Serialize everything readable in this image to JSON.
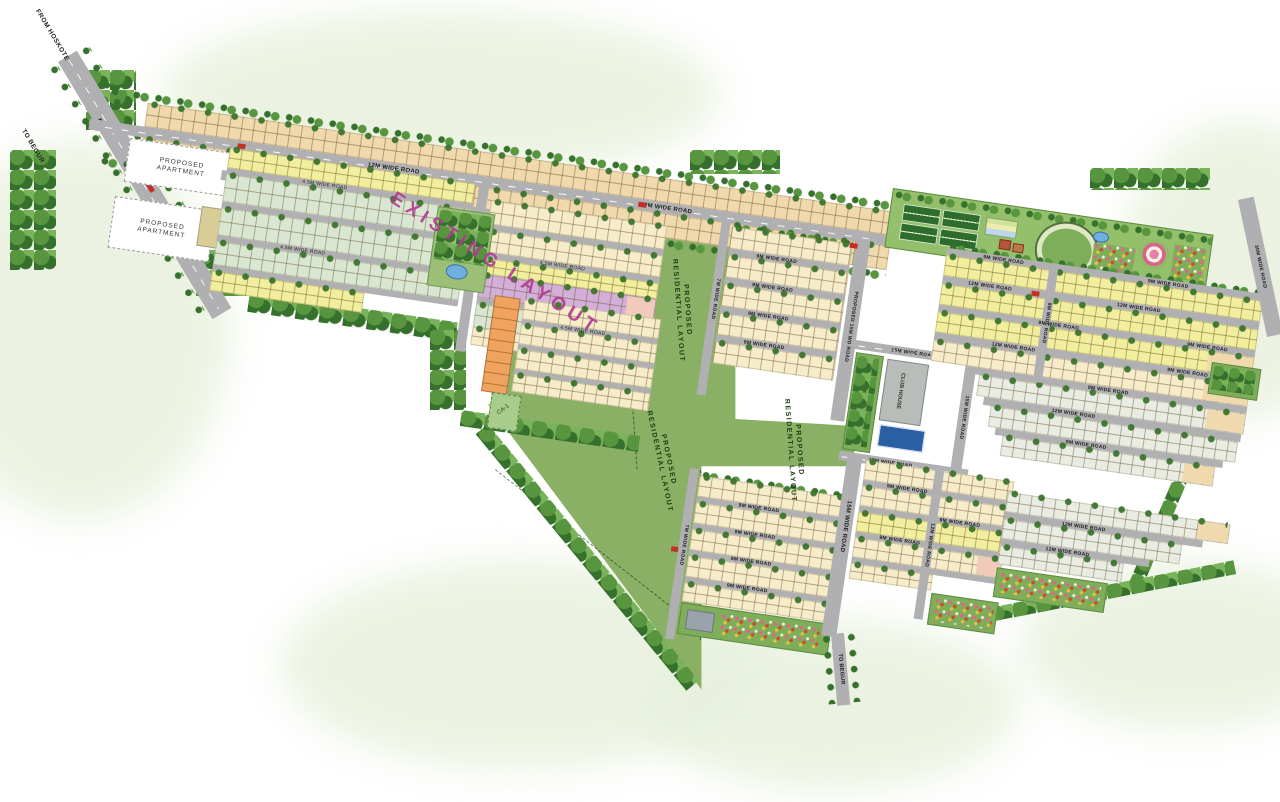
{
  "canvas": {
    "width": 1280,
    "height": 802
  },
  "labels": {
    "from_hoskote": "FROM HOSKOTE",
    "to_begur": "TO BEGUR",
    "pa_line1": "PROPOSED",
    "pa_line2": "APARTMENT",
    "existing_layout": "EXISTING LAYOUT",
    "prl_line1": "PROPOSED",
    "prl_line2": "RESIDENTIAL LAYOUT",
    "club_house": "CLUB HOUSE",
    "park": "PARK",
    "ca1": "CA-1"
  },
  "roads": {
    "r12": "12M WIDE ROAD",
    "r9": "9M WIDE ROAD",
    "r7": "7M WIDE ROAD",
    "r15": "15M WIDE ROAD",
    "r45": "4.5M WIDE ROAD",
    "r30": "30M WIDE ROAD",
    "p15": "PROPOSED 15M WD ROAD"
  },
  "colors": {
    "wash": "#e7f0dc",
    "field": "#8ab065",
    "road": "#b0afb2",
    "tan": "#efd9ad",
    "cream": "#f6ecca",
    "yellow": "#f1ee9e",
    "mint": "#d9e7d2",
    "purple": "#d2aed8",
    "orange": "#f0a35f",
    "pink": "#f2cabc",
    "grayplot": "#e9ece2",
    "beige": "#d8cd96",
    "tree_dark": "#35702c",
    "tree_mid": "#57963f",
    "tree_light": "#79b35a",
    "court": "#2f6d2f",
    "pool": "#2b5fa3",
    "magenta": "#b03a92"
  }
}
